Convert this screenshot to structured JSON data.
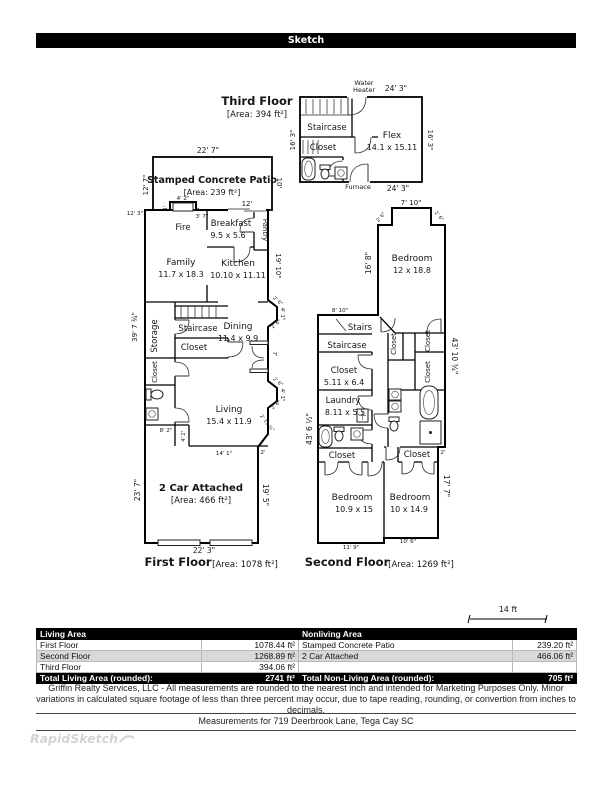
{
  "header": {
    "title": "Sketch"
  },
  "scale_bar": {
    "label": "14 ft"
  },
  "watermark": {
    "brand": "RapidSketch"
  },
  "third_floor": {
    "title": "Third Floor",
    "area": "[Area: 394 ft²]",
    "rooms": {
      "staircase": "Staircase",
      "closet": "Closet",
      "flex": "Flex",
      "flex_dims": "14.1 x 15.11"
    },
    "labels": {
      "water": "Water",
      "heater": "Heater",
      "furnace": "Furnace"
    },
    "dims": {
      "top": "24' 3\"",
      "bottom": "24' 3\"",
      "left": "16' 3\"",
      "right": "16' 3\""
    }
  },
  "first_floor": {
    "title": "First Floor",
    "area": "[Area: 1078 ft²]",
    "patio": {
      "name": "Stamped Concrete Patio",
      "area": "[Area: 239 ft²]"
    },
    "rooms": {
      "fire": "Fire",
      "breakfast": "Breakfast",
      "breakfast_dims": "9.5 x 5.6",
      "pantry": "Pantry",
      "family": "Family",
      "family_dims": "11.7 x 18.3",
      "kitchen": "Kitchen",
      "kitchen_dims": "10.10 x 11.11",
      "storage": "Storage",
      "staircase": "Staircase",
      "closet": "Closet",
      "dining": "Dining",
      "dining_dims": "11.4 x 9.9",
      "living": "Living",
      "living_dims": "15.4 x 11.9",
      "garage": "2 Car Attached",
      "garage_area": "[Area: 466 ft²]"
    },
    "dims": {
      "patio_top": "22' 7\"",
      "patio_left": "12' 7\"",
      "patio_right": "10'",
      "left_upper": "12' 3\"",
      "fire_width": "4' 2\"",
      "fire_offset": "3' 7\"",
      "one_foot": "1'",
      "breakfast_top": "12'",
      "kitchen_right": "19' 10\"",
      "left_main": "39' 7 ¾\"",
      "bay_diag": "2' 6\"",
      "bay_face": "4' 1\"",
      "door": "7'",
      "living_diag": "2' 11 ½\"",
      "step_w": "8' 2\"",
      "step_h": "4' 2\"",
      "garage_top": "14' 1\"",
      "jog": "2'",
      "garage_left": "23' 7\"",
      "garage_right": "19' 5\"",
      "garage_bottom": "22' 3\""
    }
  },
  "second_floor": {
    "title": "Second Floor",
    "area": "[Area: 1269 ft²]",
    "rooms": {
      "bedroom1": "Bedroom",
      "bedroom1_dims": "12 x 18.8",
      "stairs": "Stairs",
      "staircase": "Staircase",
      "closet": "Closet",
      "closet_a_dims": "5.11 x 6.4",
      "laundry": "Laundry",
      "laundry_dims": "8.11 x 5.5",
      "bedroom2": "Bedroom",
      "bedroom2_dims": "10.9 x 15",
      "bedroom3": "Bedroom",
      "bedroom3_dims": "10 x 14.9"
    },
    "dims": {
      "notch_top": "7' 10\"",
      "notch_side": "2' 6\"",
      "bedroom_left": "16' 8\"",
      "hall_top": "8' 10\"",
      "left_main": "43' 6 ½\"",
      "right_main": "43' 10 ¾\"",
      "jog": "2'",
      "right_lower": "17' 7\"",
      "bottom_left": "11' 9\"",
      "bottom_right": "10' 6\""
    }
  },
  "summary_table": {
    "living_header": "Living Area",
    "nonliving_header": "Nonliving Area",
    "rows": [
      {
        "living_name": "First Floor",
        "living_value": "1078.44 ft²",
        "nonliving_name": "Stamped Concrete Patio",
        "nonliving_value": "239.20 ft²"
      },
      {
        "living_name": "Second Floor",
        "living_value": "1268.89 ft²",
        "nonliving_name": "2 Car Attached",
        "nonliving_value": "466.06 ft²"
      },
      {
        "living_name": "Third Floor",
        "living_value": "394.06 ft²",
        "nonliving_name": "",
        "nonliving_value": ""
      }
    ],
    "total_living_label": "Total Living Area (rounded):",
    "total_living_value": "2741 ft²",
    "total_nonliving_label": "Total Non-Living Area (rounded):",
    "total_nonliving_value": "705 ft²"
  },
  "footer": {
    "disclaimer": "Griffin Realty Services, LLC - All measurements are rounded to the nearest inch and intended for Marketing Purposes Only. Minor variations in calculated square footage of less than three percent may occur, due to tape reading, rounding, or convertion from inches to decimals.",
    "measurements": "Measurements for 719 Deerbrook Lane, Tega Cay SC"
  }
}
